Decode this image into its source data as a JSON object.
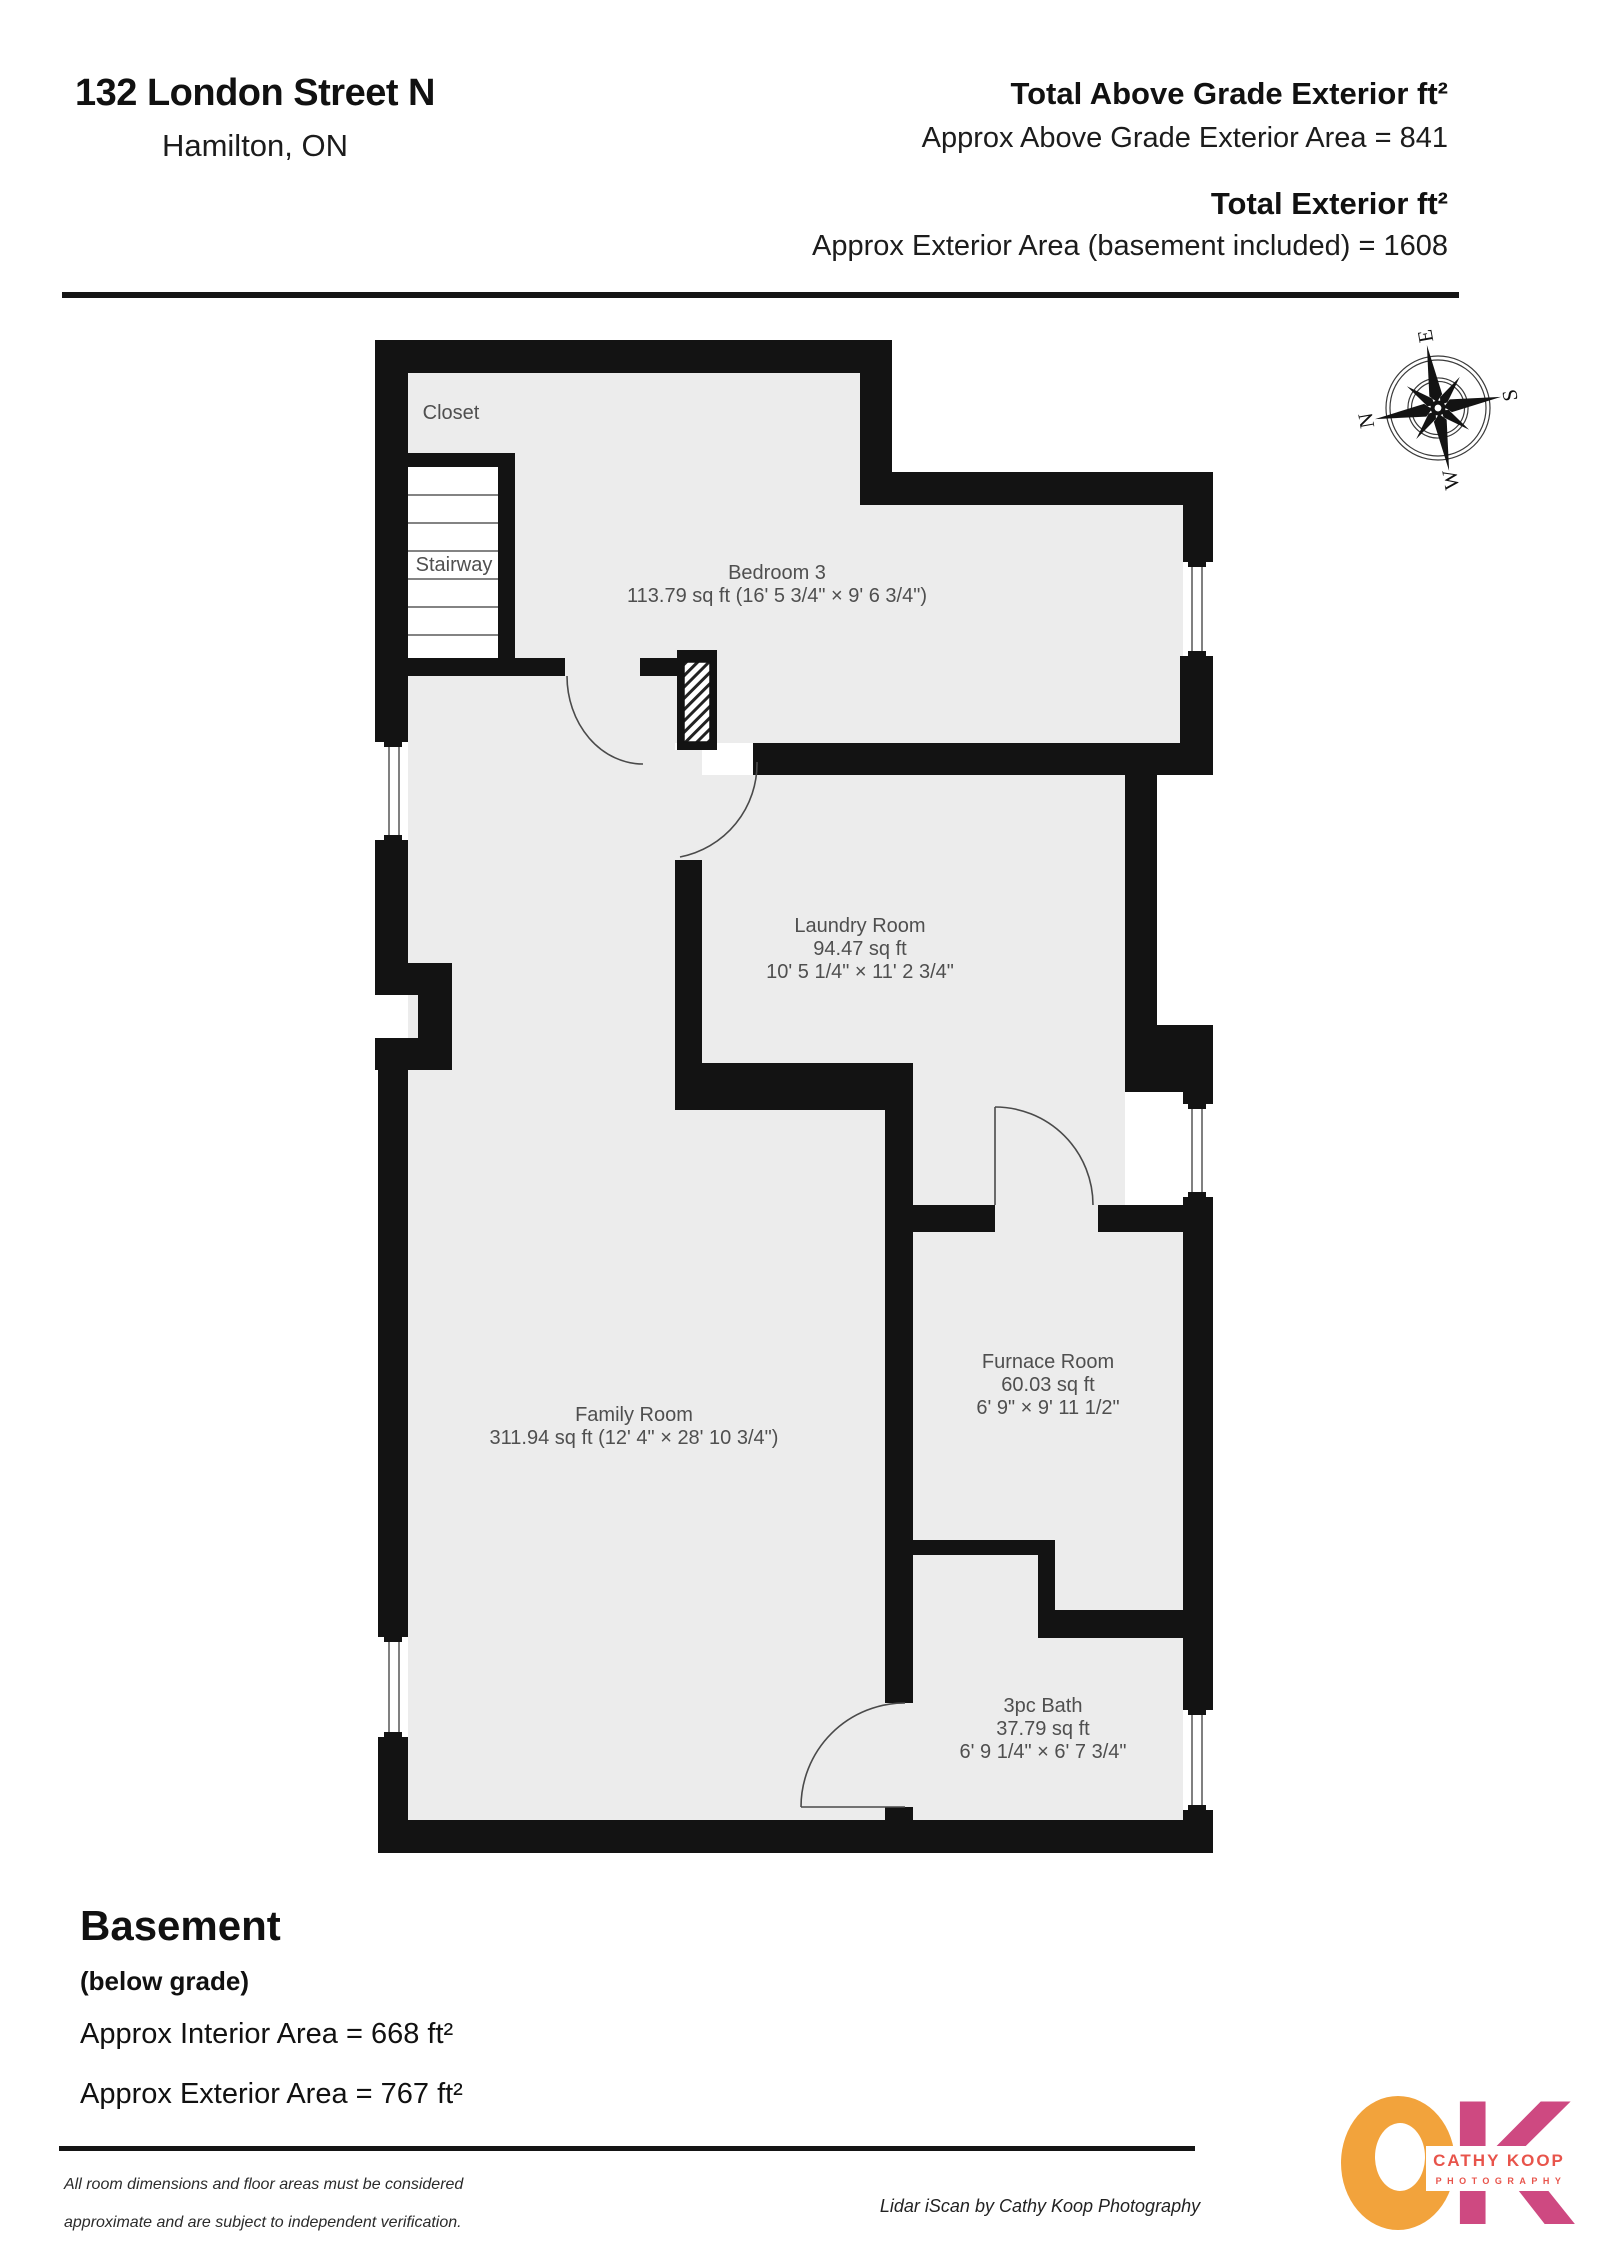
{
  "header": {
    "address": "132 London Street N",
    "city": "Hamilton, ON",
    "above_grade_title": "Total Above Grade Exterior ft²",
    "above_grade_value": "Approx Above Grade Exterior Area = 841",
    "total_title": "Total Exterior ft²",
    "total_value": "Approx Exterior Area (basement included) = 1608"
  },
  "floor": {
    "name": "Basement",
    "grade": "(below grade)",
    "interior_area": "Approx Interior Area = 668 ft²",
    "exterior_area": "Approx Exterior Area = 767 ft²"
  },
  "rooms": {
    "closet": {
      "name": "Closet"
    },
    "stairway": {
      "name": "Stairway"
    },
    "bedroom3": {
      "name": "Bedroom 3",
      "dims": "113.79 sq ft (16' 5 3/4\" × 9' 6 3/4\")"
    },
    "laundry": {
      "name": "Laundry Room",
      "area": "94.47 sq ft",
      "dims": "10' 5 1/4\" × 11' 2 3/4\""
    },
    "furnace": {
      "name": "Furnace Room",
      "area": "60.03 sq ft",
      "dims": "6' 9\" × 9' 11 1/2\""
    },
    "family": {
      "name": "Family Room",
      "dims": "311.94 sq ft (12' 4\" × 28' 10 3/4\")"
    },
    "bath": {
      "name": "3pc Bath",
      "area": "37.79 sq ft",
      "dims": "6' 9 1/4\" × 6' 7 3/4\""
    }
  },
  "compass": {
    "n": "N",
    "e": "E",
    "s": "S",
    "w": "W"
  },
  "footer": {
    "disclaimer_line1": "All room dimensions and floor areas must be considered",
    "disclaimer_line2": "approximate and are subject to independent verification.",
    "credit": "Lidar iScan by Cathy Koop Photography"
  },
  "logo": {
    "k": "K",
    "line1": "CATHY KOOP",
    "line2": "PHOTOGRAPHY"
  },
  "colors": {
    "wall": "#131313",
    "floor": "#ececec",
    "logo_orange": "#F2A33C",
    "logo_pink": "#CE4981",
    "logo_red": "#E8544B"
  }
}
